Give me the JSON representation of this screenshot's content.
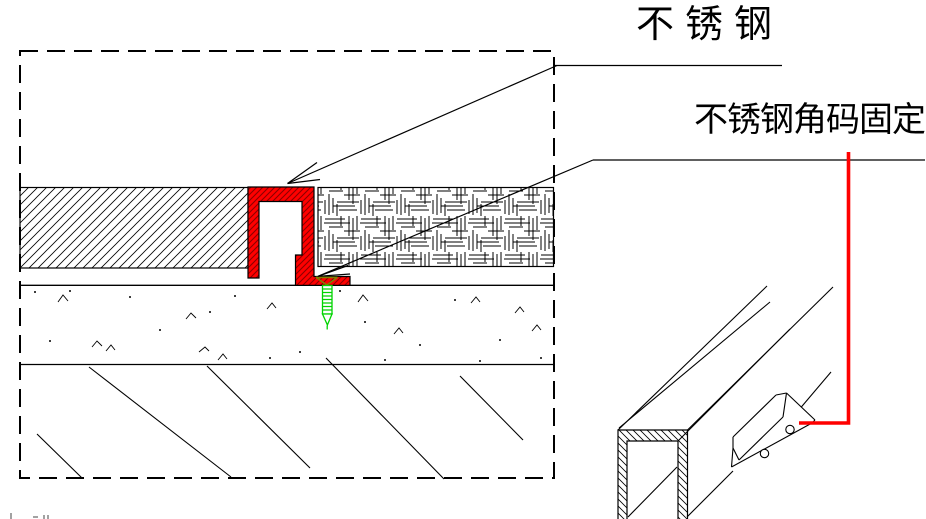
{
  "labels": {
    "stainless_steel": "不锈钢",
    "bracket_fixing": "不锈钢角码固定"
  },
  "annotations": [
    {
      "label": "不锈钢",
      "points_to": "stainless-steel-channel-top"
    },
    {
      "label": "不锈钢角码固定",
      "points_to": "screw-and-angle-bracket"
    }
  ],
  "colors": {
    "channel_red": "#ff0000",
    "channel_hatch_dark": "#8b0000",
    "screw_green": "#00d400",
    "screw_head_olive": "#7f7f00",
    "annotation_red": "#ff0000",
    "line_black": "#000000",
    "background": "#ffffff",
    "fragment_gray": "#8a8a8a"
  }
}
